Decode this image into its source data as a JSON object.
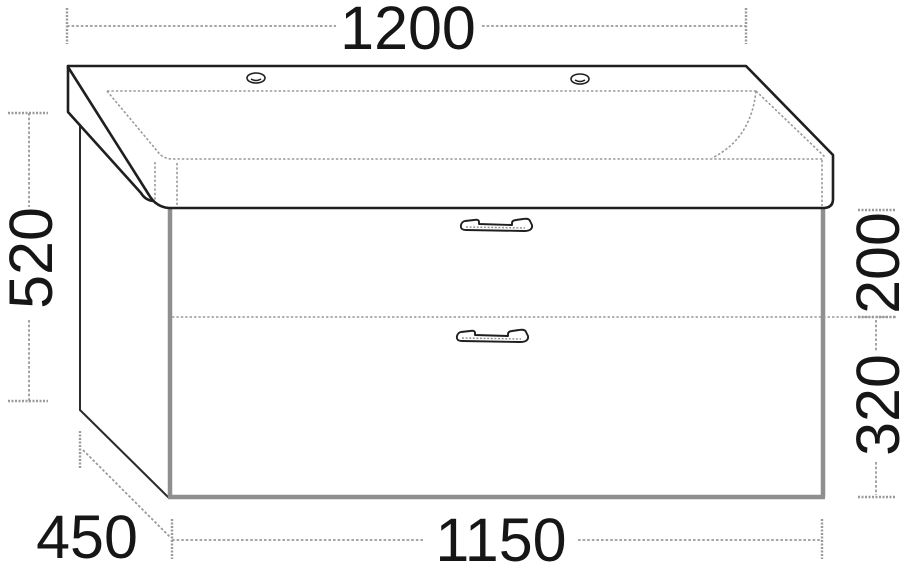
{
  "diagram": {
    "dimension_labels": {
      "basin_width": "1200",
      "unit_height": "520",
      "top_drawer_height": "200",
      "bottom_drawer_height": "320",
      "depth": "450",
      "cabinet_width": "1150"
    },
    "colors": {
      "outline_dark": "#1f1f1f",
      "edge_gray": "#8f8f8f",
      "dimension_gray": "#9a9a9a",
      "label_text": "#161616",
      "background": "#ffffff"
    },
    "icons": {
      "faucet_hole": "small slotted ellipse on basin deck",
      "drawer_handle": "bow bar handle outline"
    }
  }
}
